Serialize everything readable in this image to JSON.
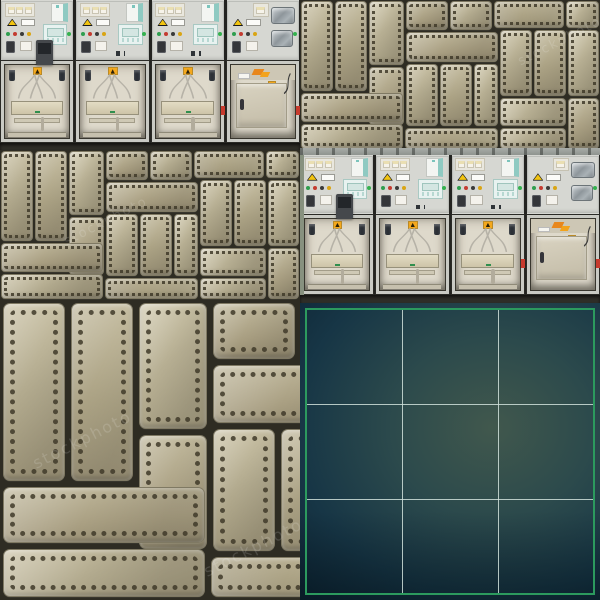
{
  "page": {
    "description": "Collage of stock images: medium-voltage switchgear cabinet photos, riveted khaki metal plate textures, and a dark teal rule-of-thirds grid panel"
  },
  "watermark": {
    "text": "stockphoto"
  },
  "tiles": [
    {
      "id": "a",
      "type": "switchgear",
      "label": "switchgear cabinets photo",
      "has_ceiling": false,
      "has_wall": false,
      "floor_h": 7
    },
    {
      "id": "b",
      "type": "rivets",
      "label": "riveted metal texture",
      "scale": 1
    },
    {
      "id": "c",
      "type": "rivets",
      "label": "riveted metal texture",
      "scale": 1
    },
    {
      "id": "d",
      "type": "switchgear",
      "label": "switchgear cabinets photo",
      "has_ceiling": true,
      "has_wall": true,
      "floor_h": 8
    },
    {
      "id": "e",
      "type": "rivets",
      "label": "riveted metal texture enlarged",
      "scale": 2
    },
    {
      "id": "f",
      "type": "grid",
      "label": "dark teal grid panel"
    }
  ],
  "switchgear": {
    "cabinet_count": 4,
    "panel_color": "#d6d7d2",
    "compartment_color": "#ded9cb",
    "relay_color": "#8fcac2",
    "warning_color": "#f2c411",
    "orange_color": "#e8871c",
    "indicator_colors": [
      "#2f9e4f",
      "#c43b30",
      "#3a3a3a",
      "#d9a514"
    ],
    "cabinets": [
      {
        "variant": "relay",
        "has_meter": true,
        "red_cap": false
      },
      {
        "variant": "relay",
        "has_meter": false,
        "red_cap": false
      },
      {
        "variant": "relay",
        "has_meter": false,
        "red_cap": true
      },
      {
        "variant": "door",
        "has_meter": false,
        "red_cap": true
      }
    ]
  },
  "rivet_texture": {
    "plate_color": "#b2aa8e",
    "gap_color": "#2e2c23",
    "rivet_color": "#403a2a",
    "plates": [
      [
        2,
        2,
        30,
        88
      ],
      [
        36,
        2,
        30,
        88
      ],
      [
        70,
        2,
        33,
        62
      ],
      [
        107,
        2,
        40,
        27
      ],
      [
        151,
        2,
        40,
        27
      ],
      [
        195,
        2,
        68,
        25
      ],
      [
        267,
        2,
        31,
        25
      ],
      [
        107,
        33,
        90,
        28
      ],
      [
        201,
        31,
        30,
        64
      ],
      [
        235,
        31,
        30,
        64
      ],
      [
        269,
        31,
        29,
        64
      ],
      [
        70,
        68,
        33,
        56
      ],
      [
        107,
        65,
        30,
        60
      ],
      [
        141,
        65,
        30,
        60
      ],
      [
        175,
        65,
        22,
        60
      ],
      [
        2,
        94,
        100,
        27
      ],
      [
        2,
        125,
        100,
        23
      ],
      [
        106,
        129,
        91,
        19
      ],
      [
        201,
        99,
        64,
        26
      ],
      [
        269,
        99,
        29,
        49
      ],
      [
        201,
        129,
        64,
        19
      ]
    ]
  },
  "grid_overlay": {
    "rows": 3,
    "cols": 3,
    "border_color": "#2c9a5e",
    "line_color": "#d0e0da",
    "bg_center": "#41584d",
    "bg_corner": "#0c2232"
  }
}
